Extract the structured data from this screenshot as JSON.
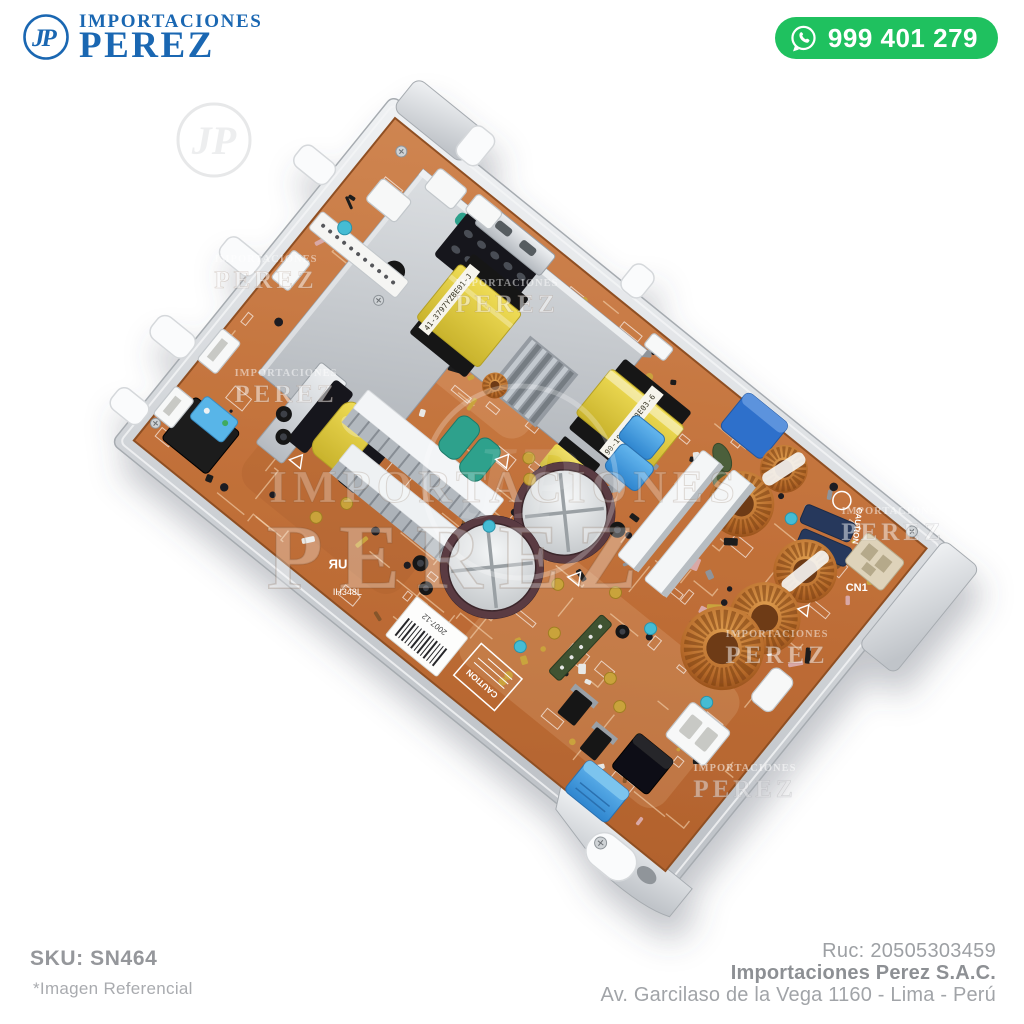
{
  "header": {
    "logo": {
      "line1": "IMPORTACIONES",
      "line2": "PEREZ",
      "monogram": "JP"
    },
    "whatsapp": {
      "phone": "999 401 279"
    }
  },
  "watermark": {
    "line1": "IMPORTACIONES",
    "line2": "PEREZ",
    "monogram": "JP"
  },
  "board": {
    "labels": {
      "caution": "CAUTION",
      "cn1": "CN1",
      "transformer_big": "41-3797YZBE01-J",
      "transformer_right": "90-19A17YZ8E03-6",
      "date_code": "2007-12",
      "model": "IH348L",
      "ul_mark": "ЯU"
    },
    "colors": {
      "pcb": "#c1743f",
      "frame": "#d9dcdf",
      "copper": "#b5692a",
      "transformer_yellow": "#e3cf42",
      "cap_blue": "#3f9ee5",
      "relay_blue": "#58b5e8",
      "teal": "#2fa18c",
      "shield": "#c3c7cc"
    }
  },
  "footer": {
    "sku": "SKU: SN464",
    "disclaimer": "*Imagen Referencial",
    "ruc": "Ruc: 20505303459",
    "company": "Importaciones Perez S.A.C.",
    "address": "Av. Garcilaso de la Vega 1160 - Lima - Perú"
  },
  "theme": {
    "brand_blue": "#1a67b2",
    "whatsapp_green": "#1fc15f",
    "text_gray": "#9b9da1"
  }
}
